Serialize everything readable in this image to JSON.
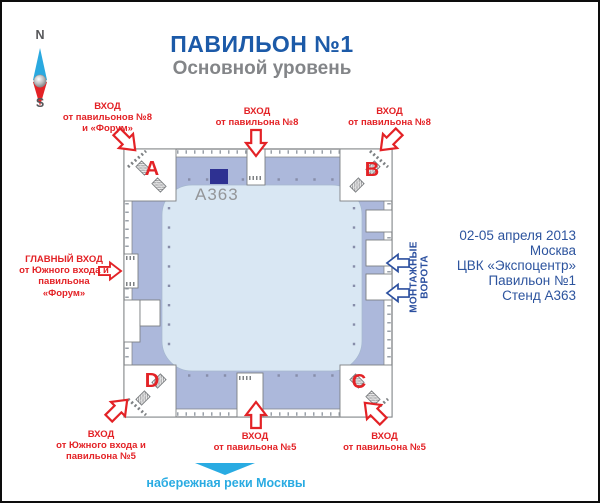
{
  "header": {
    "title": "ПАВИЛЬОН №1",
    "subtitle": "Основной уровень"
  },
  "compass": {
    "north": "N",
    "south": "S"
  },
  "plan": {
    "corners": {
      "a": "А",
      "b": "В",
      "c": "С",
      "d": "D"
    },
    "stand": {
      "id": "А363",
      "marker_color": "#2e3192"
    },
    "entrances": {
      "top_left": "ВХОД\nот павильонов №8\nи «Форум»",
      "top_center": "ВХОД\nот павильона №8",
      "top_right": "ВХОД\nот павильона №8",
      "main": "ГЛАВНЫЙ ВХОД\nот Южного входа и\nпавильона\n«Форум»",
      "bottom_left": "ВХОД\nот Южного входа и\nпавильона №5",
      "bottom_center": "ВХОД\nот павильона №5",
      "bottom_right": "ВХОД\nот павильона №5"
    },
    "gates_label": "МОНТАЖНЫЕ ВОРОТА",
    "embankment_label": "набережная реки Москвы"
  },
  "info": {
    "lines": [
      "02-05 апреля 2013",
      "Москва",
      "ЦВК «Экспоцентр»",
      "Павильон №1",
      "Стенд А363"
    ]
  },
  "colors": {
    "accent_red": "#e32226",
    "band_blue": "#acb8db",
    "hall_blue": "#d9e7f3",
    "title_blue": "#1c5aa8",
    "info_blue": "#2d549e",
    "river_cyan": "#29abe2",
    "gates_blue": "#2b4f9f",
    "stand_navy": "#2e3192"
  }
}
